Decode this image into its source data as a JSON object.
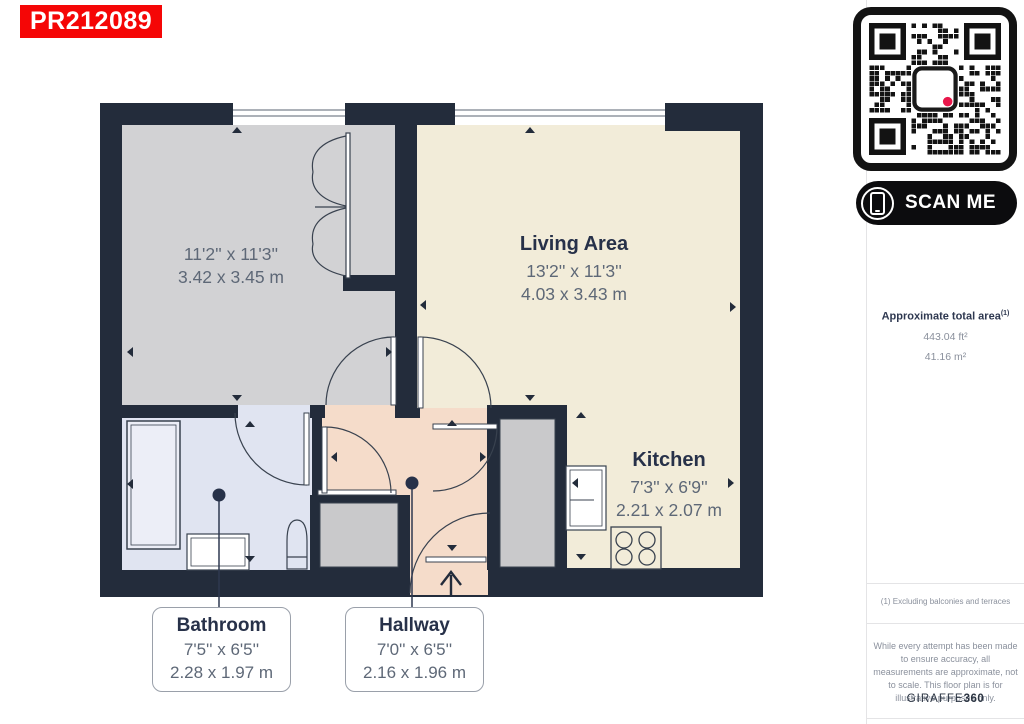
{
  "badge": {
    "reference": "PR212089"
  },
  "plan": {
    "rooms": {
      "bedroom": {
        "dims_imperial": "11'2'' x 11'3''",
        "dims_metric": "3.42 x 3.45 m"
      },
      "living_area": {
        "name": "Living Area",
        "dims_imperial": "13'2'' x 11'3''",
        "dims_metric": "4.03 x 3.43 m"
      },
      "kitchen": {
        "name": "Kitchen",
        "dims_imperial": "7'3'' x 6'9''",
        "dims_metric": "2.21 x 2.07 m"
      },
      "bathroom": {
        "name": "Bathroom",
        "dims_imperial": "7'5'' x 6'5''",
        "dims_metric": "2.28 x 1.97 m"
      },
      "hallway": {
        "name": "Hallway",
        "dims_imperial": "7'0'' x 6'5''",
        "dims_metric": "2.16 x 1.96 m"
      }
    },
    "colors": {
      "wall": "#232c3b",
      "bedroom_floor": "#d2d2d4",
      "living_floor": "#f2ecd9",
      "hallway_floor": "#f5dcca",
      "bathroom_floor": "#e0e4f1",
      "closet_floor": "#c9c9cb",
      "badge_red": "#f50606",
      "qr_dot_red": "#e8174b"
    }
  },
  "sidebar": {
    "scan_me": "SCAN ME",
    "area": {
      "title": "Approximate total area",
      "note_ref": "(1)",
      "imperial": "443.04 ft²",
      "metric": "41.16 m²"
    },
    "footnote": "(1) Excluding balconies and terraces",
    "disclaimer": "While every attempt has been made to ensure accuracy, all measurements are approximate, not to scale. This floor plan is for illustrative purposes only.",
    "brand": {
      "name": "GIRAFFE",
      "number": "360"
    }
  }
}
